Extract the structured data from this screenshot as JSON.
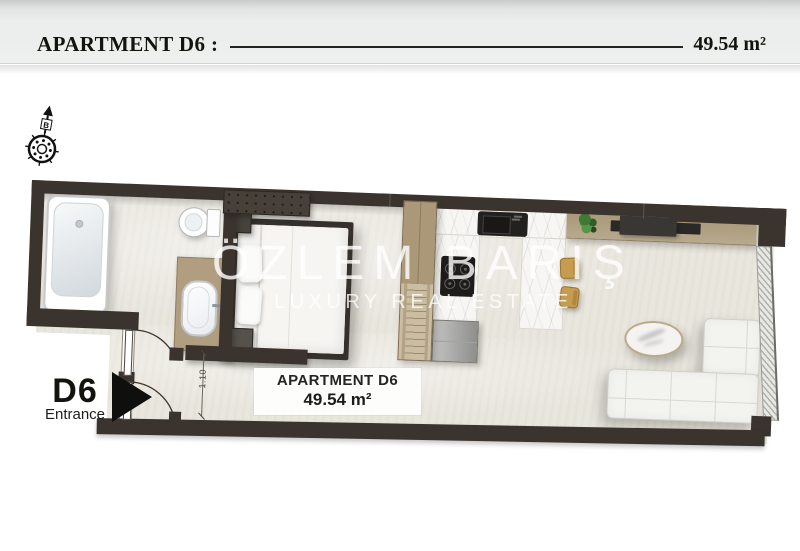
{
  "header": {
    "title": "APARTMENT D6 :",
    "area": "49.54 m²"
  },
  "compass": {
    "north_label": "B"
  },
  "watermark": {
    "brand": "ÖZLEM BARIŞ",
    "tagline": "LUXURY REAL ESTATE"
  },
  "plan_badge": {
    "title": "APARTMENT D6",
    "area": "49.54 m²"
  },
  "entrance": {
    "unit": "D6",
    "label": "Entrance"
  },
  "dimension": {
    "label": "1.10"
  },
  "books": [
    "#a63127",
    "#d9b98a",
    "#e07b2f",
    "#edeae2",
    "#3f6fa8",
    "#2f8f8a",
    "#d98a3d",
    "#6a4d9e",
    "#b78b4e"
  ],
  "colors": {
    "wall": "#3a332e",
    "floor": "#e9e6de",
    "wood_cabinet": "#b19e80",
    "wood_shelf": "#a89878",
    "marble": "#f7f6f3",
    "stool_gold": "#c69c50",
    "sofa_white": "#f3f3f0",
    "plant_green": "#3e7a33",
    "fridge_gray": "#a9a9a7"
  },
  "furniture_icons": [
    "bathtub",
    "toilet",
    "vanity-sink",
    "double-bed",
    "wardrobe",
    "kitchen-counter",
    "kitchen-sink",
    "cooktop",
    "refrigerator",
    "bar-counter",
    "bar-stools",
    "media-shelf",
    "tv",
    "books-row",
    "plant",
    "coffee-table",
    "sectional-sofa",
    "window-wall",
    "entrance-door",
    "bathroom-door"
  ]
}
